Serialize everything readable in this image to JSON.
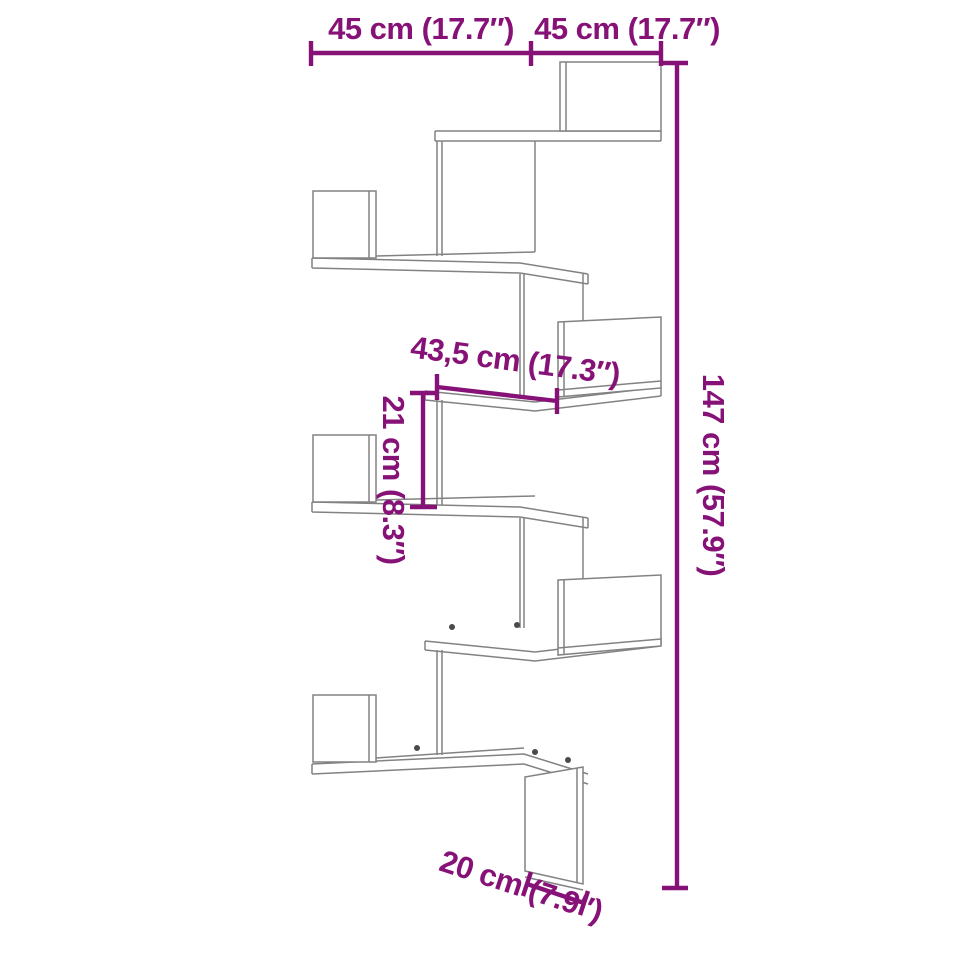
{
  "diagram": {
    "subject": "wall-mounted corner shelf dimension diagram",
    "style": {
      "dimension_color": "#871277",
      "drawing_line_color": "#828282",
      "background": "#ffffff"
    },
    "labels": {
      "width_left": "45 cm (17.7″)",
      "width_right": "45 cm (17.7″)",
      "shelf_width": "43,5 cm (17.3″)",
      "compartment_height": "21 cm (8.3″)",
      "total_height": "147 cm (57.9″)",
      "bottom_depth": "20 cm (7.9″)"
    },
    "values": {
      "width_left": {
        "cm": "45",
        "inch": "17.7"
      },
      "width_right": {
        "cm": "45",
        "inch": "17.7"
      },
      "shelf_width": {
        "cm": "43,5",
        "inch": "17.3"
      },
      "compartment_height": {
        "cm": "21",
        "inch": "8.3"
      },
      "total_height": {
        "cm": "147",
        "inch": "57.9"
      },
      "bottom_depth": {
        "cm": "20",
        "inch": "7.9"
      }
    }
  }
}
